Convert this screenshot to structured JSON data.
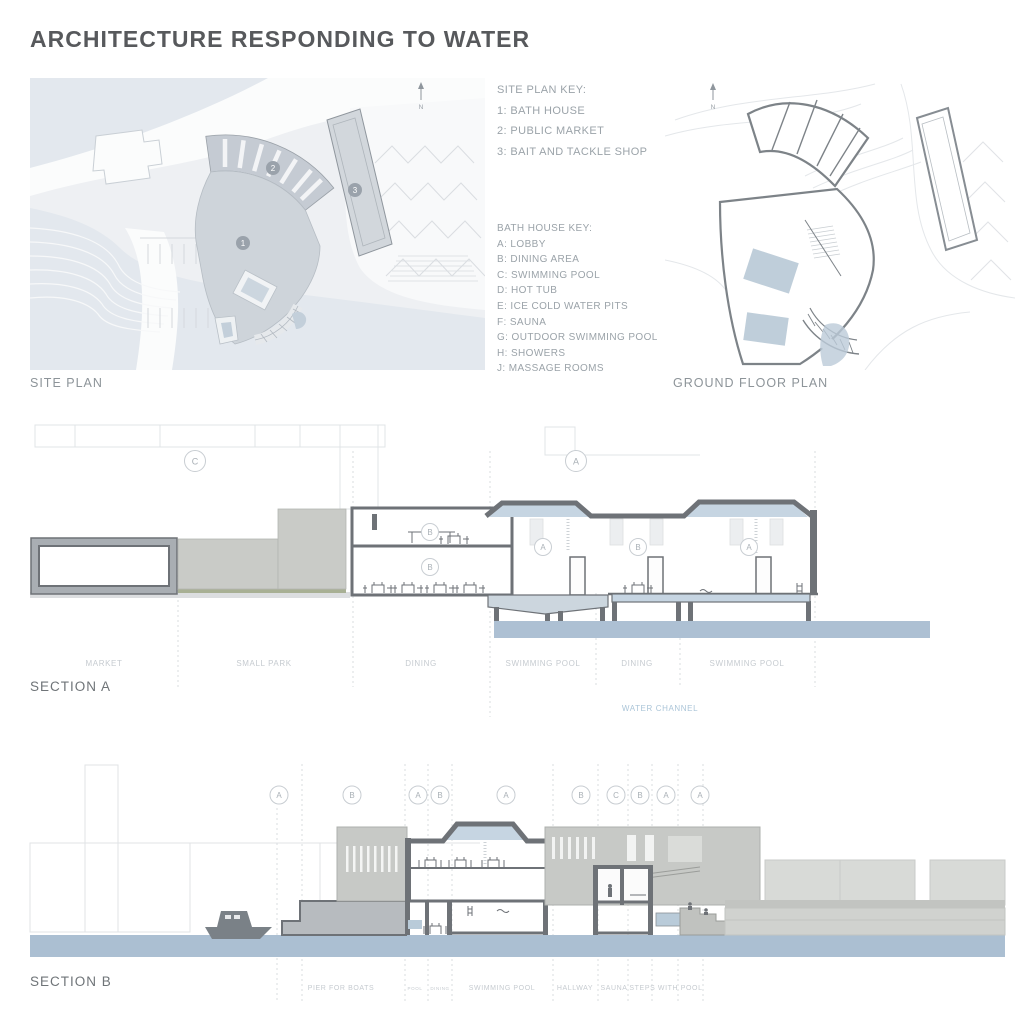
{
  "title": "ARCHITECTURE RESPONDING TO WATER",
  "colors": {
    "title_text": "#57595c",
    "key_text": "#9ba3a9",
    "plan_label_text": "#8d9499",
    "zone_label_text": "#c6cbd0",
    "wall_gray": "#6e7277",
    "water_blue": "#adc0d3",
    "skylight_blue": "#c6d5e2",
    "concrete_gray": "#c8cac7",
    "water_channel_text": "#abc5d8"
  },
  "site_plan": {
    "label": "SITE PLAN",
    "north_label": "N",
    "markers": [
      "1",
      "2",
      "3"
    ],
    "key": {
      "title": "SITE PLAN KEY:",
      "items": [
        "1: BATH HOUSE",
        "2: PUBLIC MARKET",
        "3: BAIT AND TACKLE SHOP"
      ]
    }
  },
  "bath_house_key": {
    "title": "BATH HOUSE KEY:",
    "items": [
      "A: LOBBY",
      "B: DINING AREA",
      "C: SWIMMING POOL",
      "D: HOT TUB",
      "E: ICE COLD WATER PITS",
      "F: SAUNA",
      "G: OUTDOOR SWIMMING POOL",
      "H: SHOWERS",
      "J: MASSAGE ROOMS"
    ]
  },
  "ground_floor_plan": {
    "label": "GROUND FLOOR PLAN",
    "north_label": "N"
  },
  "section_a": {
    "label": "SECTION A",
    "grid_markers": [
      "C",
      "A"
    ],
    "room_markers": [
      "B",
      "B",
      "A",
      "B",
      "A"
    ],
    "zone_labels": [
      "MARKET",
      "SMALL PARK",
      "DINING",
      "SWIMMING POOL",
      "DINING",
      "SWIMMING POOL"
    ],
    "water_label": "WATER CHANNEL"
  },
  "section_b": {
    "label": "SECTION B",
    "grid_markers": [
      "A",
      "B",
      "A",
      "B",
      "A",
      "B",
      "C",
      "B",
      "A",
      "A"
    ],
    "zone_labels": [
      "PIER FOR BOATS",
      "POOL",
      "DINING",
      "SWIMMING POOL",
      "HALLWAY",
      "SAUNA",
      "STEPS WITH POOL"
    ]
  }
}
